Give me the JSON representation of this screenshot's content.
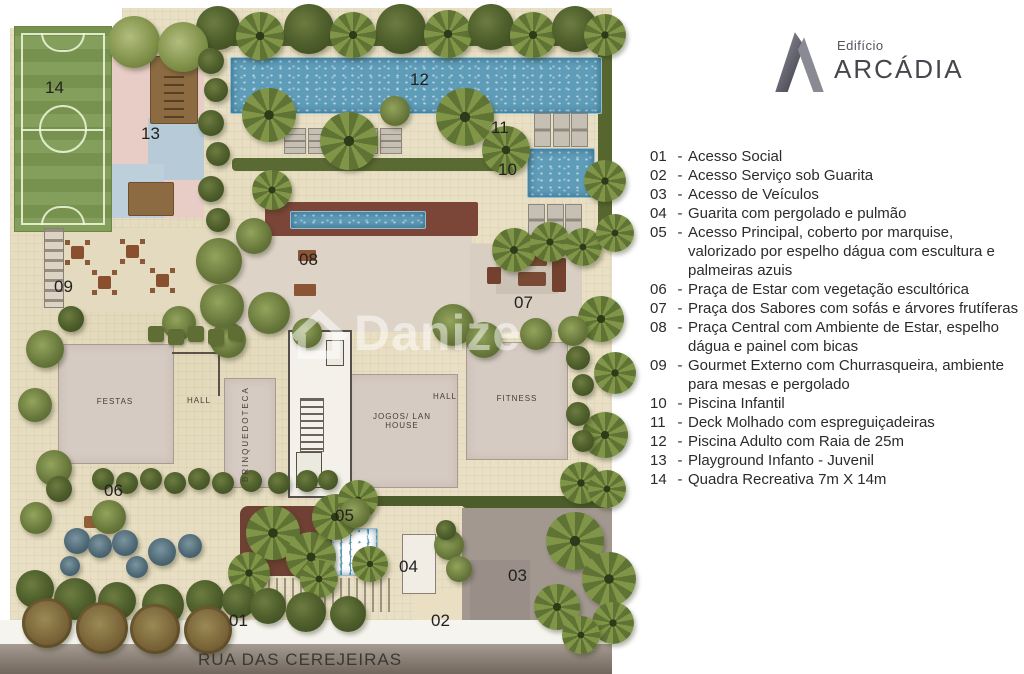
{
  "logo": {
    "building_word": "Edifício",
    "name": "ARCÁDIA"
  },
  "legend": {
    "separator": "-",
    "items": [
      {
        "num": "01",
        "text": "Acesso Social"
      },
      {
        "num": "02",
        "text": "Acesso Serviço sob Guarita"
      },
      {
        "num": "03",
        "text": "Acesso de Veículos"
      },
      {
        "num": "04",
        "text": "Guarita com pergolado e pulmão"
      },
      {
        "num": "05",
        "text": "Acesso Principal, coberto por marquise, valorizado por espelho dágua com escultura e palmeiras azuis"
      },
      {
        "num": "06",
        "text": "Praça de Estar com vegetação escultórica"
      },
      {
        "num": "07",
        "text": "Praça dos Sabores com sofás e árvores frutíferas"
      },
      {
        "num": "08",
        "text": "Praça Central com Ambiente de Estar, espelho dágua e painel com bicas"
      },
      {
        "num": "09",
        "text": "Gourmet Externo com Churrasqueira, ambiente para mesas e pergolado"
      },
      {
        "num": "10",
        "text": "Piscina Infantil"
      },
      {
        "num": "11",
        "text": "Deck Molhado com espreguiçadeiras"
      },
      {
        "num": "12",
        "text": "Piscina Adulto com Raia de 25m"
      },
      {
        "num": "13",
        "text": "Playground Infanto - Juvenil"
      },
      {
        "num": "14",
        "text": "Quadra Recreativa 7m X 14m"
      }
    ]
  },
  "plan": {
    "street_name": "RUA DAS CEREJEIRAS",
    "watermark": "Danize",
    "markers": [
      "01",
      "02",
      "03",
      "04",
      "05",
      "06",
      "07",
      "08",
      "09",
      "10",
      "11",
      "12",
      "13",
      "14"
    ],
    "rooms": {
      "festas": "FESTAS",
      "hall_left": "HALL",
      "brinquedoteca": "BRINQUEDOTECA",
      "jogos": "JOGOS/ LAN HOUSE",
      "hall_right": "HALL",
      "fitness": "FITNESS"
    }
  },
  "colors": {
    "pool_blue": "#5e9cb8",
    "field_green": "#7d9a52",
    "paving_beige": "#e9dfc4",
    "maroon_red": "#7b4538",
    "building_room_gray": "#d6cbc3",
    "street_gray": "#8d8379",
    "legend_text": "#2b2b2b",
    "logo_gray": "#46464e",
    "watermark_white": "rgba(255,255,255,0.5)"
  }
}
